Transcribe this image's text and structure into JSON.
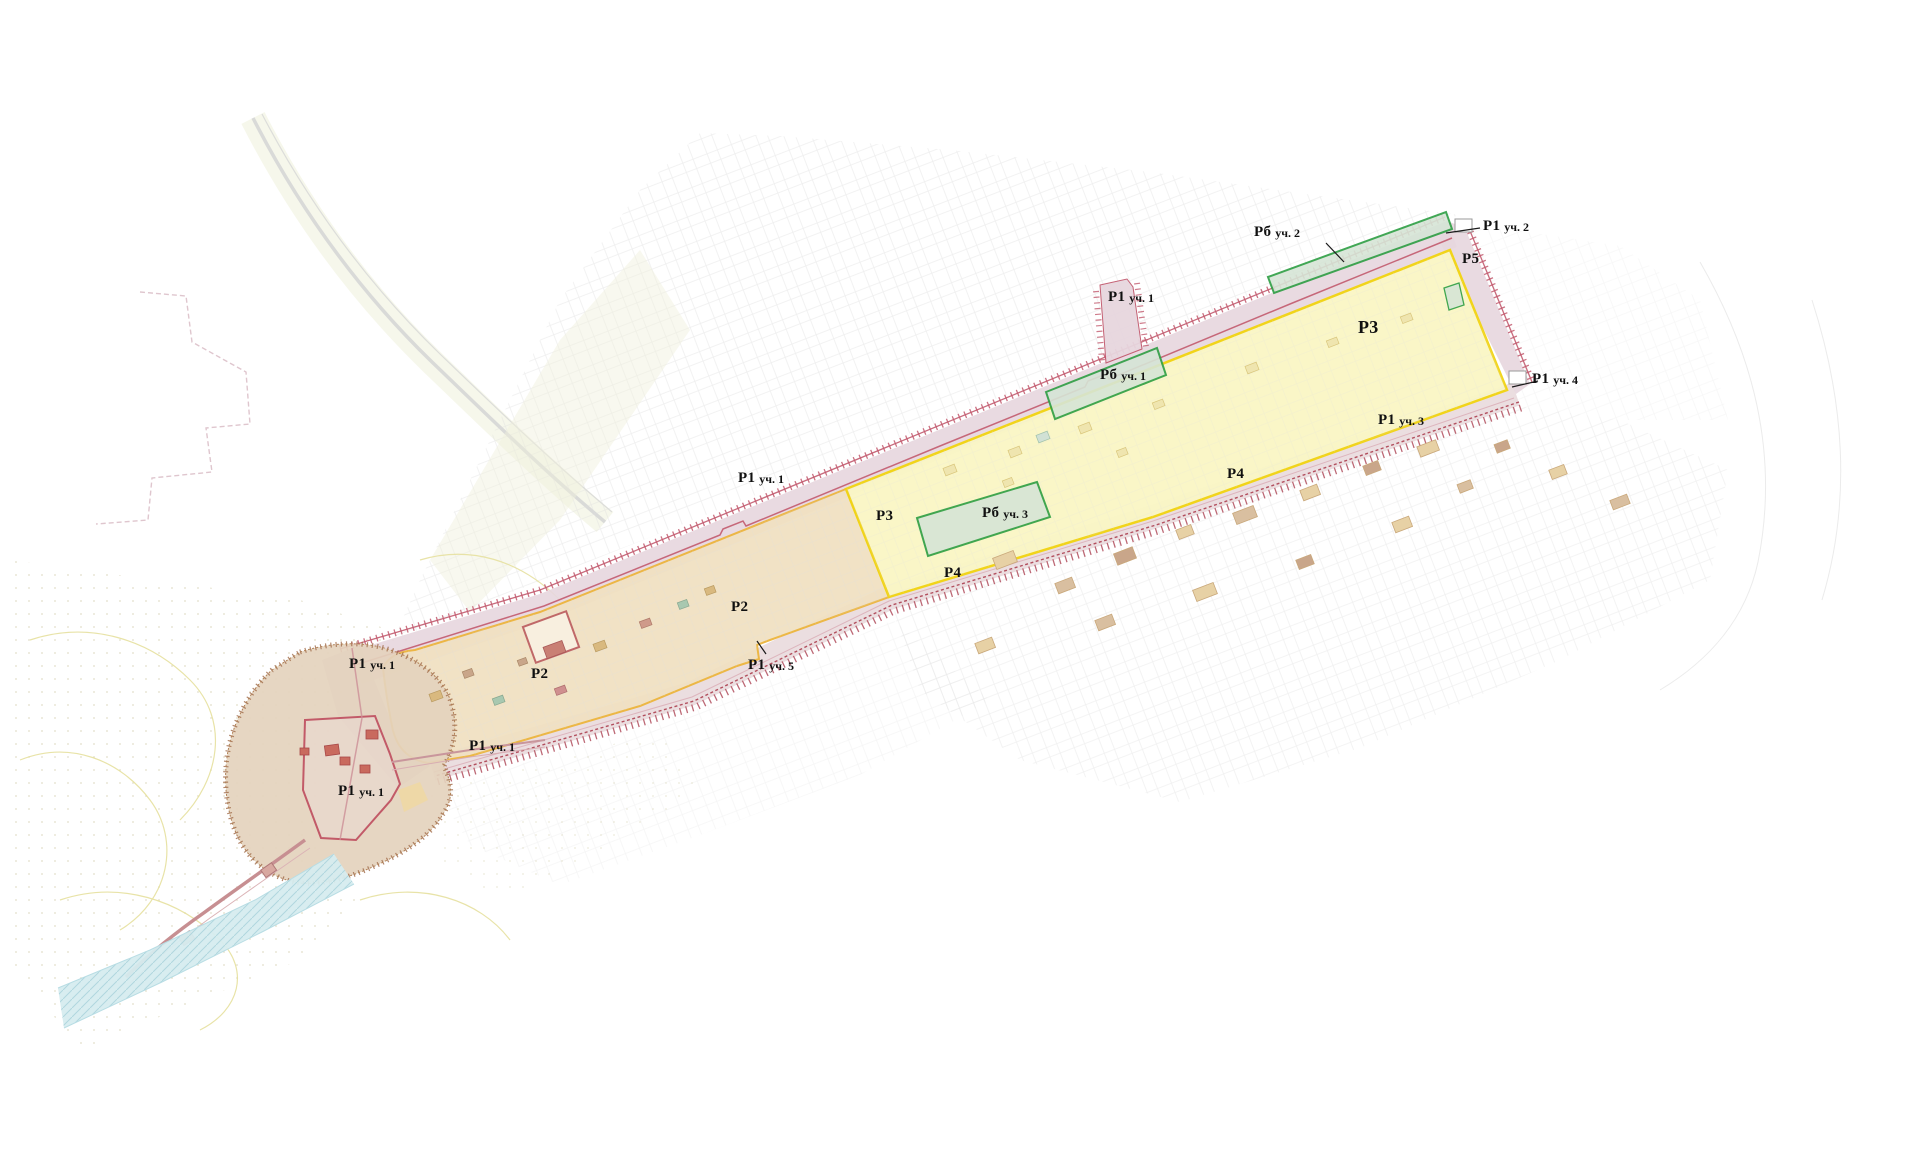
{
  "map": {
    "description": "Plan of heritage protection zones with numbered regime areas",
    "labels": [
      {
        "primary": "Рб",
        "secondary": "уч. 2"
      },
      {
        "primary": "Р1",
        "secondary": "уч. 2"
      },
      {
        "primary": "Р5",
        "secondary": ""
      },
      {
        "primary": "Р1",
        "secondary": "уч. 1"
      },
      {
        "primary": "Р3",
        "secondary": ""
      },
      {
        "primary": "Рб",
        "secondary": "уч. 1"
      },
      {
        "primary": "Р1",
        "secondary": "уч. 4"
      },
      {
        "primary": "Р1",
        "secondary": "уч. 3"
      },
      {
        "primary": "Р1",
        "secondary": "уч. 1"
      },
      {
        "primary": "Р4",
        "secondary": ""
      },
      {
        "primary": "Р3",
        "secondary": ""
      },
      {
        "primary": "Рб",
        "secondary": "уч. 3"
      },
      {
        "primary": "Р4",
        "secondary": ""
      },
      {
        "primary": "Р2",
        "secondary": ""
      },
      {
        "primary": "Р2",
        "secondary": ""
      },
      {
        "primary": "Р1",
        "secondary": "уч. 1"
      },
      {
        "primary": "Р1",
        "secondary": "уч. 5"
      },
      {
        "primary": "Р1",
        "secondary": "уч. 1"
      },
      {
        "primary": "Р1",
        "secondary": "уч. 1"
      }
    ],
    "colors": {
      "background": "#ffffff",
      "band_fill": "#e7d6de",
      "band_line": "#c25a6e",
      "corridor_fill": "#ded0d4",
      "corridor_hatch": "#b24f5e",
      "p2_fill": "#f1e1c2",
      "p2_stroke": "#edb53d",
      "p3_fill": "#faf6c6",
      "p3_stroke": "#f2d414",
      "green_fill": "#d6e5d6",
      "green_stroke": "#2d9e43",
      "fort_fill": "#e4d3bd",
      "fort_border": "#a06a48",
      "fort_inner": "#c25a68",
      "river_fill": "#d6ecef",
      "river_hatch": "#a6d1da",
      "urban_line": "#dedede",
      "field_dot": "#d0caa6",
      "contour_line": "#e6e09e",
      "bldg_fill": "#e7d1a5",
      "bldg_stroke": "#c9a87b",
      "road_line": "#d6d6d6",
      "zigzag_line": "#d9bcc5",
      "label_color": "#101010"
    }
  }
}
